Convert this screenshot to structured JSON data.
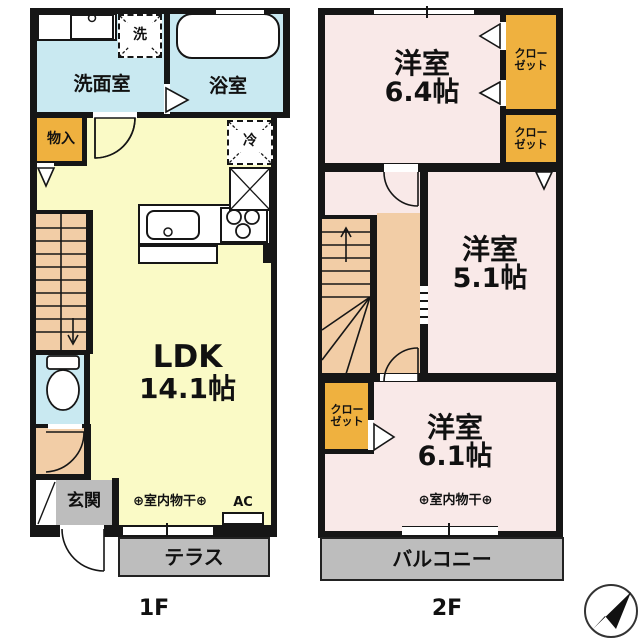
{
  "document": {
    "type": "floor-plan",
    "floors_shown": 2
  },
  "floor1": {
    "label": "1F",
    "washroom": "洗面室",
    "bathroom": "浴室",
    "washer": "洗",
    "storage": "物入",
    "fridge": "冷",
    "ldk_name": "LDK",
    "ldk_size": "14.1帖",
    "entrance": "玄関",
    "terrace": "テラス",
    "drying": "⊕室内物干⊕",
    "ac": "AC"
  },
  "floor2": {
    "label": "2F",
    "rooms": [
      {
        "name": "洋室",
        "size": "6.4帖"
      },
      {
        "name": "洋室",
        "size": "5.1帖"
      },
      {
        "name": "洋室",
        "size": "6.1帖"
      }
    ],
    "closet_line1": "クロー",
    "closet_line2": "ゼット",
    "drying": "⊕室内物干⊕",
    "balcony": "バルコニー"
  },
  "compass": {
    "icon": "north-east-arrow"
  },
  "colors": {
    "wall": "#161616",
    "water_blue": "#c9e9f1",
    "ldk_yellow": "#fafac6",
    "stairs_tan": "#f2cda6",
    "closet_orange": "#efb13f",
    "room_pink": "#f9e9e8",
    "outdoor_gray": "#bdbdbd"
  }
}
